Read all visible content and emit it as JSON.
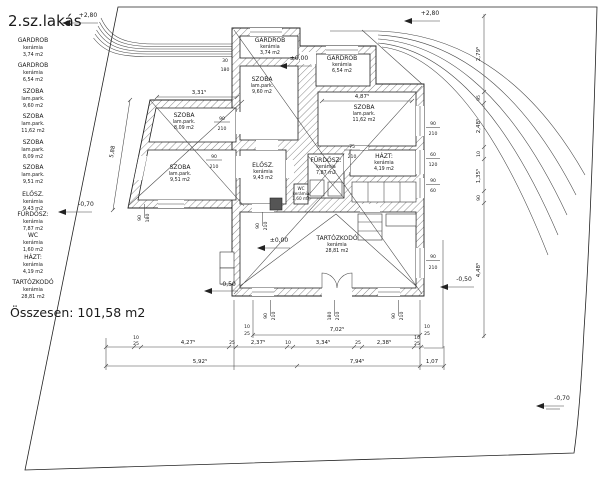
{
  "title": "2.sz.lakás",
  "legend": {
    "items": [
      {
        "name": "GARDROB",
        "material": "kerámia",
        "area": "3,74 m2"
      },
      {
        "name": "GARDROB",
        "material": "kerámia",
        "area": "6,54 m2"
      },
      {
        "name": "SZOBA",
        "material": "lam.park.",
        "area": "9,60 m2"
      },
      {
        "name": "SZOBA",
        "material": "lam.park.",
        "area": "11,62 m2"
      },
      {
        "name": "SZOBA",
        "material": "lam.park.",
        "area": "8,09 m2"
      },
      {
        "name": "SZOBA",
        "material": "lam.park.",
        "area": "9,51 m2"
      },
      {
        "name": "ELŐSZ.",
        "material": "kerámia",
        "area": "9,43 m2"
      },
      {
        "name": "FÜRDŐSZ:",
        "material": "kerámia",
        "area": "7,87 m2"
      },
      {
        "name": "WC",
        "material": "kerámia",
        "area": "1,60 m2"
      },
      {
        "name": "HÁZT:",
        "material": "kerámia",
        "area": "4,19 m2"
      },
      {
        "name": "TARTÓZKODÓ",
        "material": "kerámia",
        "area": "28,81 m2"
      }
    ],
    "total": "Összesen:  101,58  m2"
  },
  "elev": {
    "p280": "+2,80",
    "z0": "±0,00",
    "m50": "-0,50",
    "m70": "-0,70"
  },
  "dims": {
    "d331": "3,31⁵",
    "d487": "4,87⁵",
    "d588": "5,88",
    "d702": "7,02⁵",
    "d427": "4,27⁵",
    "d237": "2,37⁵",
    "d334": "3,34⁵",
    "d238": "2,38⁵",
    "d592": "5,92⁵",
    "d794": "7,94⁵",
    "d107": "1,07",
    "d279": "2,79⁵",
    "d95": "95",
    "d248": "2,48⁵",
    "d135": "1,35⁵",
    "d448": "4,48⁵",
    "n10": "10",
    "n25": "25",
    "n30": "30",
    "n60": "60",
    "n75": "75",
    "n90": "90",
    "n120": "120",
    "n180": "180",
    "n210": "210"
  }
}
